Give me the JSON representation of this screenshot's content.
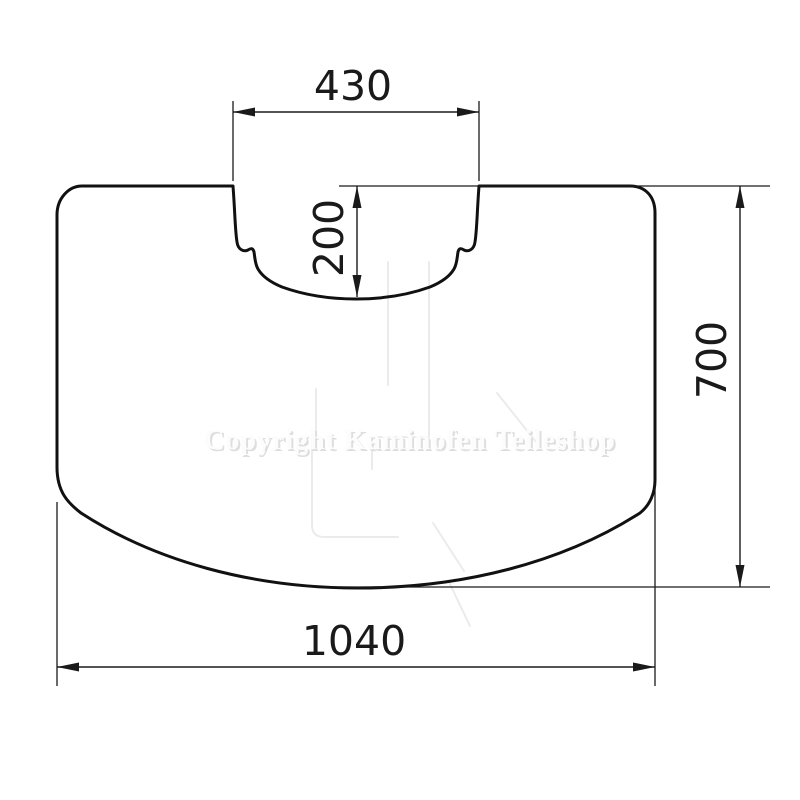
{
  "drawing": {
    "type": "technical-dimension-drawing",
    "part": "fireplace floor plate with rear flue cut-out",
    "dimensions": {
      "cutout_width": {
        "label": "430",
        "orientation": "horizontal",
        "position": "top"
      },
      "cutout_depth": {
        "label": "200",
        "orientation": "vertical",
        "position": "center-top"
      },
      "plate_height": {
        "label": "700",
        "orientation": "vertical",
        "position": "right"
      },
      "plate_width": {
        "label": "1040",
        "orientation": "horizontal",
        "position": "bottom"
      }
    },
    "watermark": {
      "text": "Copyright Kaminofen Teileshop"
    },
    "colors": {
      "background": "#ffffff",
      "outline": "#111111",
      "dimension": "#1a1a1a",
      "watermark_line": "#ebebeb",
      "watermark_text_front": "#fcfcfc",
      "watermark_text_shadow": "#dedede"
    }
  }
}
